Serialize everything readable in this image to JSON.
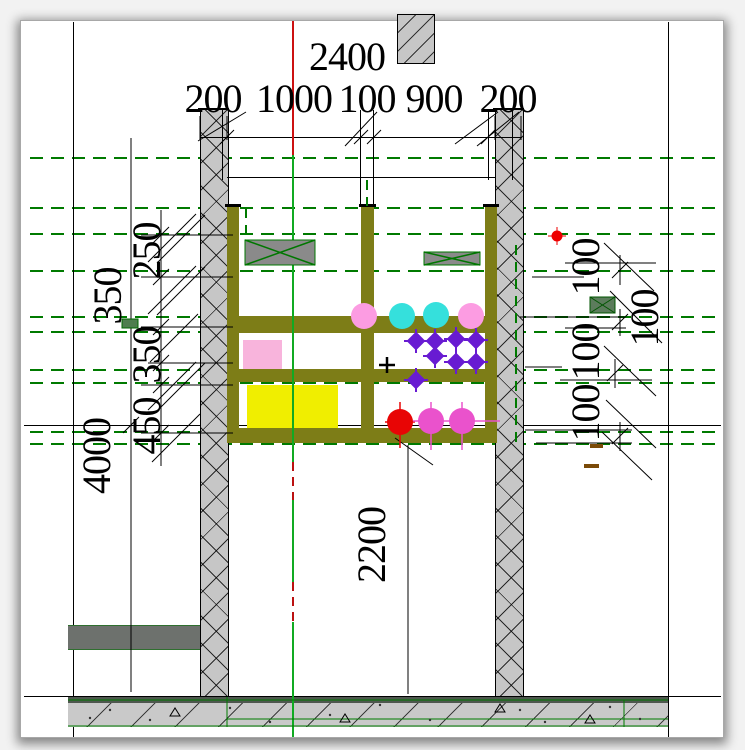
{
  "dimensions": {
    "top_total": "2400",
    "top_chain": [
      "200",
      "1000",
      "100",
      "900",
      "200"
    ],
    "left_total": "4000",
    "left_mid": "350",
    "left_chain": [
      "250",
      "350",
      "450"
    ],
    "right_chain": [
      "100",
      "100",
      "100",
      "100"
    ],
    "interior_height": "2200"
  },
  "palette": {
    "wall_fill": "#c6c6c6",
    "frame_olive": "#7d7d17",
    "slab_fill": "#c9c9c9",
    "slab_top_strip": "#4e574e",
    "left_band_gray": "#6d716d",
    "centerline_green": "#11aa22",
    "centerline_red": "#cc1111",
    "dashed_green": "#007a00",
    "equipment_gray": "#8a8a8a",
    "equipment_cross_green": "#007700",
    "marker_purple": "#681bd2",
    "marker_cyan": "#35e0dc",
    "marker_pink": "#fc9ce2",
    "marker_magenta": "#ea52cc",
    "marker_red": "#e80505",
    "box_pink": "#f8b4dc",
    "box_yellow": "#f0ee00",
    "small_box_dark_green": "#4e7d4e"
  }
}
